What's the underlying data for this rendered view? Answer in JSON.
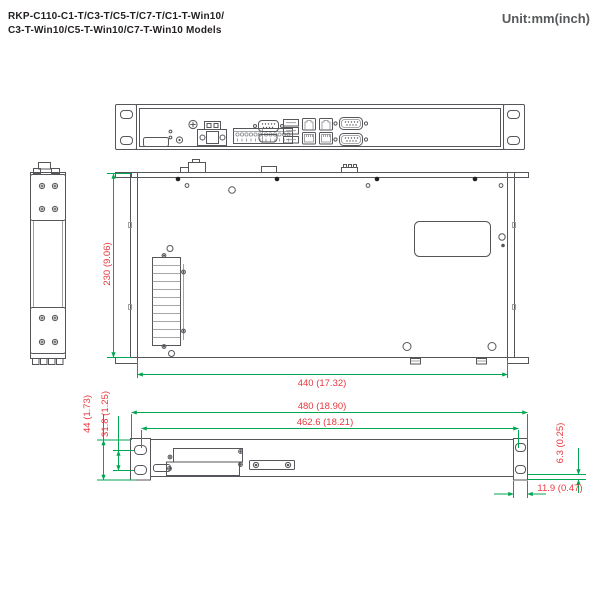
{
  "header": {
    "title_line1": "RKP-C110-C1-T/C3-T/C5-T/C7-T/C1-T-Win10/",
    "title_line2": "C3-T-Win10/C5-T-Win10/C7-T-Win10 Models",
    "unit_label": "Unit:mm(inch)"
  },
  "dimensions": {
    "depth": "230 (9.06)",
    "chassis_width": "440 (17.32)",
    "overall_width": "480 (18.90)",
    "mounting_span": "462.6 (18.21)",
    "front_height": "44 (1.73)",
    "ear_hole_spacing": "31.8 (1.25)",
    "hole_edge_offset": "6.3 (0.25)",
    "ear_depth": "11.9 (0.47)"
  },
  "colors": {
    "dimension_line": "#00a651",
    "dimension_text": "#e8383d",
    "drawing_stroke": "#55565a",
    "title_text": "#231f20",
    "unit_text": "#58595b"
  },
  "icons": {
    "front_panel": [
      "status-leds-icon",
      "power-button-icon",
      "grounding-screw-icon",
      "power-terminal-icon",
      "io-terminal-block-icon",
      "vga-port-icon",
      "hdmi-port-icon",
      "usb-ports-icon",
      "lan-ports-icon",
      "serial-port-icon"
    ],
    "top_view": [
      "heatsink-icon",
      "screw-icon",
      "label-cutout-icon"
    ]
  }
}
